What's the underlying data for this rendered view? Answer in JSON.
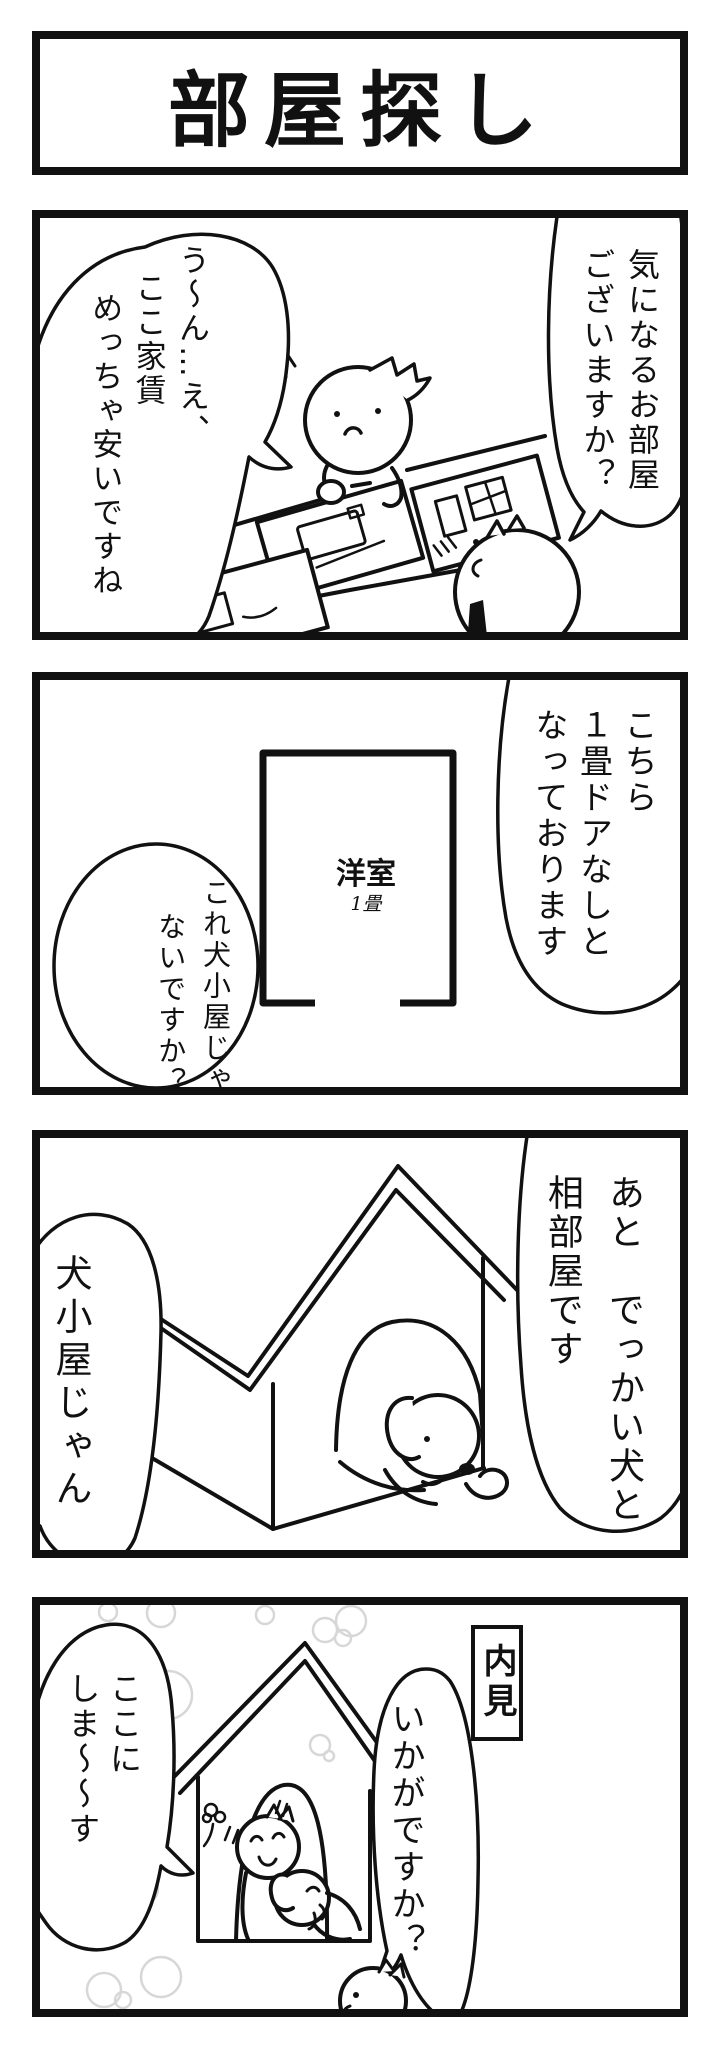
{
  "comic": {
    "title": "部屋探し",
    "colors": {
      "ink": "#111111",
      "paper": "#ffffff",
      "soap_bubble_gray": "#d7d7d7"
    },
    "panels": [
      {
        "speech_right": [
          "気になるお部屋",
          "ございますか？"
        ],
        "speech_left": [
          "う〜ん…え、",
          "ここ家賃",
          "めっちゃ安いですね"
        ]
      },
      {
        "speech_right": [
          "こちら",
          "１畳ドアなしと",
          "なっております"
        ],
        "speech_left": [
          "これ犬小屋じゃ",
          "ないですか？"
        ],
        "floorplan": {
          "room": "洋室",
          "size": "1畳"
        }
      },
      {
        "speech_right": [
          "あと　でっかい犬と",
          "相部屋です"
        ],
        "speech_left": [
          "犬小屋じゃん"
        ]
      },
      {
        "caption": "内見",
        "speech_right": [
          "いかがですか？"
        ],
        "speech_left": [
          "ここに",
          "しま〜〜す"
        ]
      }
    ]
  }
}
